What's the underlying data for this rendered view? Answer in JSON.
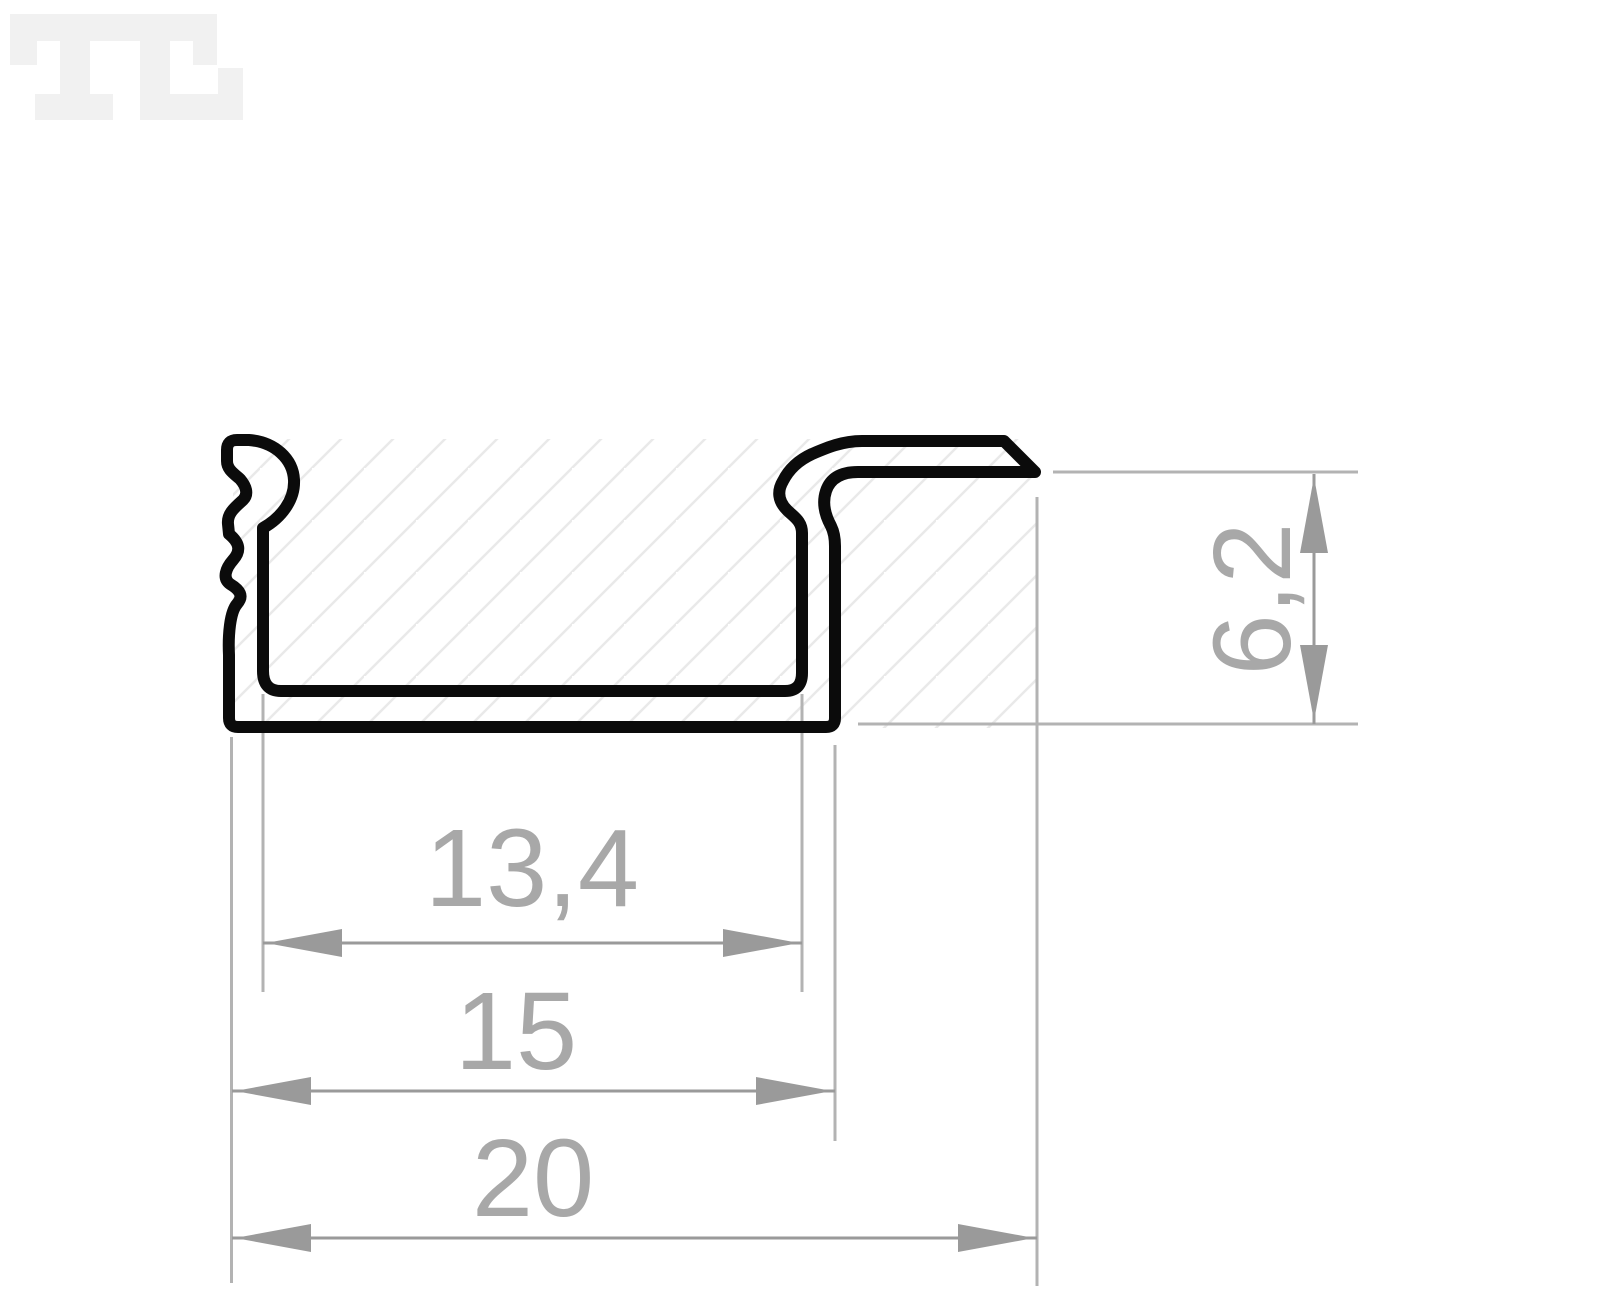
{
  "drawing": {
    "kind": "LED aluminium profile cross-section, dimensioned technical drawing",
    "colors": {
      "outline": "#0b0b0b",
      "dimension": "#9a9a9a",
      "dimension_text": "#a8a8a8",
      "extension_line": "#b3b3b3",
      "hatch": "#e9e9e9",
      "watermark": "#f1f1f1",
      "background": "#ffffff"
    },
    "dimensions": {
      "inner_width": {
        "label": "13,4",
        "orientation": "horizontal"
      },
      "outer_width": {
        "label": "15",
        "orientation": "horizontal"
      },
      "total_width": {
        "label": "20",
        "orientation": "horizontal"
      },
      "height": {
        "label": "6,2",
        "orientation": "vertical"
      }
    }
  },
  "logo": {
    "name": "TL pixel watermark"
  }
}
